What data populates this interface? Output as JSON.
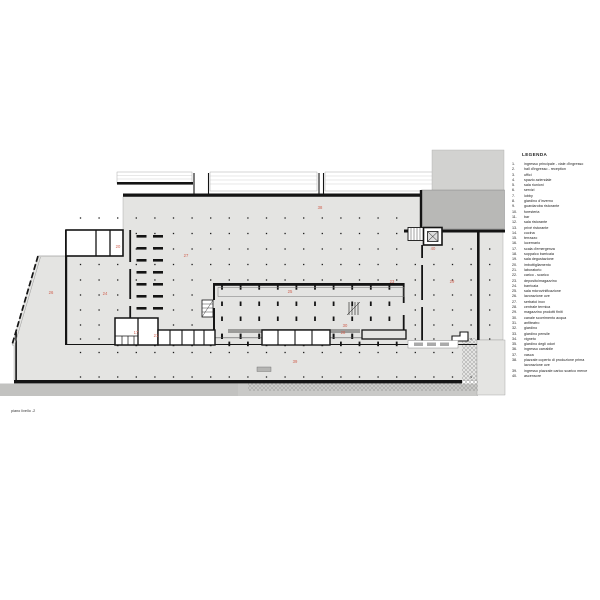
{
  "drawing": {
    "caption": "piano livello -2",
    "legend": {
      "title": "LEGENDA",
      "items": [
        {
          "n": "1.",
          "label": "ingresso principale - viale d'ingresso"
        },
        {
          "n": "2.",
          "label": "hall d'ingresso - reception"
        },
        {
          "n": "3.",
          "label": "uffici"
        },
        {
          "n": "4.",
          "label": "spazio aziendale"
        },
        {
          "n": "5.",
          "label": "sala riunioni"
        },
        {
          "n": "6.",
          "label": "servizi"
        },
        {
          "n": "7.",
          "label": "lobby"
        },
        {
          "n": "8.",
          "label": "giardino d'inverno"
        },
        {
          "n": "9.",
          "label": "guardaroba ristorante"
        },
        {
          "n": "10.",
          "label": "foresteria"
        },
        {
          "n": "11.",
          "label": "bar"
        },
        {
          "n": "12.",
          "label": "sala ristorante"
        },
        {
          "n": "13.",
          "label": "privé ristorante"
        },
        {
          "n": "14.",
          "label": "cucina"
        },
        {
          "n": "15.",
          "label": "terrazzo"
        },
        {
          "n": "16.",
          "label": "lucernario"
        },
        {
          "n": "17.",
          "label": "scala d'emergenza"
        },
        {
          "n": "18.",
          "label": "soppalco barricaia"
        },
        {
          "n": "19.",
          "label": "sala degustazione"
        },
        {
          "n": "20.",
          "label": "imbottigliamento"
        },
        {
          "n": "21.",
          "label": "laboratorio"
        },
        {
          "n": "22.",
          "label": "carico - scarico"
        },
        {
          "n": "23.",
          "label": "deposito/magazzino"
        },
        {
          "n": "24.",
          "label": "barricaia"
        },
        {
          "n": "25.",
          "label": "sala microvinificazione"
        },
        {
          "n": "26.",
          "label": "lavorazione uve"
        },
        {
          "n": "27.",
          "label": "serbatoi inox"
        },
        {
          "n": "28.",
          "label": "centrale termica"
        },
        {
          "n": "29.",
          "label": "magazzino prodotti finiti"
        },
        {
          "n": "30.",
          "label": "canale scorrimento acqua"
        },
        {
          "n": "31.",
          "label": "anfiteatro"
        },
        {
          "n": "32.",
          "label": "giardino"
        },
        {
          "n": "33.",
          "label": "giardino pensile"
        },
        {
          "n": "34.",
          "label": "vigneto"
        },
        {
          "n": "35.",
          "label": "giardino degli odori"
        },
        {
          "n": "36.",
          "label": "ingresso carrabile"
        },
        {
          "n": "37.",
          "label": "vasca"
        },
        {
          "n": "38.",
          "label": "piazzale coperto di produzione prima lavorazione uve"
        },
        {
          "n": "39.",
          "label": "ingresso piazzale carico scarico merce"
        },
        {
          "n": "40.",
          "label": "ascensore"
        }
      ]
    },
    "plan_labels": [
      {
        "n": "38",
        "x": 320,
        "y": 209
      },
      {
        "n": "20",
        "x": 118,
        "y": 248
      },
      {
        "n": "27",
        "x": 186,
        "y": 257
      },
      {
        "n": "24",
        "x": 105,
        "y": 295
      },
      {
        "n": "26",
        "x": 51,
        "y": 294
      },
      {
        "n": "25",
        "x": 290,
        "y": 293
      },
      {
        "n": "30",
        "x": 345,
        "y": 327
      },
      {
        "n": "40",
        "x": 433,
        "y": 250
      },
      {
        "n": "23",
        "x": 392,
        "y": 283
      },
      {
        "n": "29",
        "x": 452,
        "y": 283
      },
      {
        "n": "17",
        "x": 136,
        "y": 334
      },
      {
        "n": "21",
        "x": 156,
        "y": 337
      },
      {
        "n": "28",
        "x": 343,
        "y": 334
      },
      {
        "n": "39",
        "x": 295,
        "y": 363
      }
    ],
    "colors": {
      "slab": "#e4e4e2",
      "dark_block": "#b8b8b6",
      "upper_block": "#d2d2d0",
      "road": "#c9c9c7",
      "wall": "#141414",
      "label_red": "#cf5f4e"
    }
  }
}
